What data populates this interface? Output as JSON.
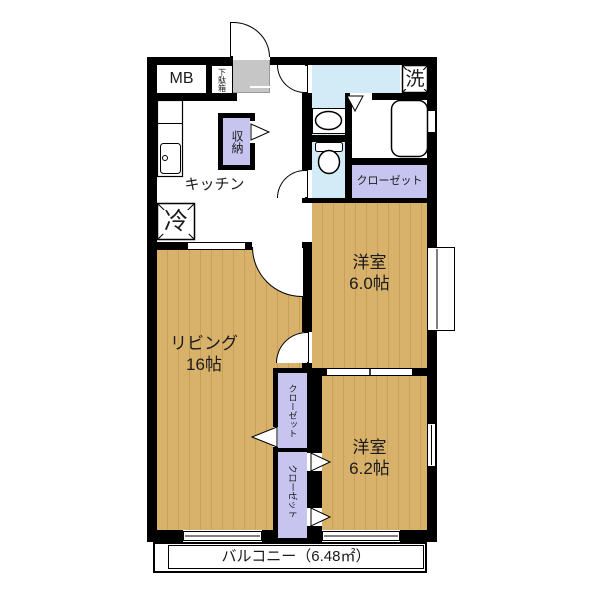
{
  "plan_title": "2LDK apartment floor plan",
  "labels": {
    "mb": "MB",
    "shoe_box": "下駄箱",
    "washer": "洗",
    "storage": "収納",
    "kitchen": "キッチン",
    "fridge": "冷",
    "closet_bedroom1": "クローゼット",
    "bedroom1_name": "洋室",
    "bedroom1_size": "6.0帖",
    "living_name": "リビング",
    "living_size": "16帖",
    "closet_hall_upper": "クローゼット",
    "closet_hall_lower": "クローゼット",
    "bedroom2_name": "洋室",
    "bedroom2_size": "6.2帖",
    "balcony": "バルコニー（6.48㎡）"
  },
  "colors": {
    "wall": "#000000",
    "wood_floor": "#d8b26b",
    "wood_grain": "#c9a055",
    "wet_area": "#d2ebf7",
    "closet_fill": "#c7c5f0",
    "entry_gray": "#c6c6c6",
    "background": "#ffffff"
  }
}
